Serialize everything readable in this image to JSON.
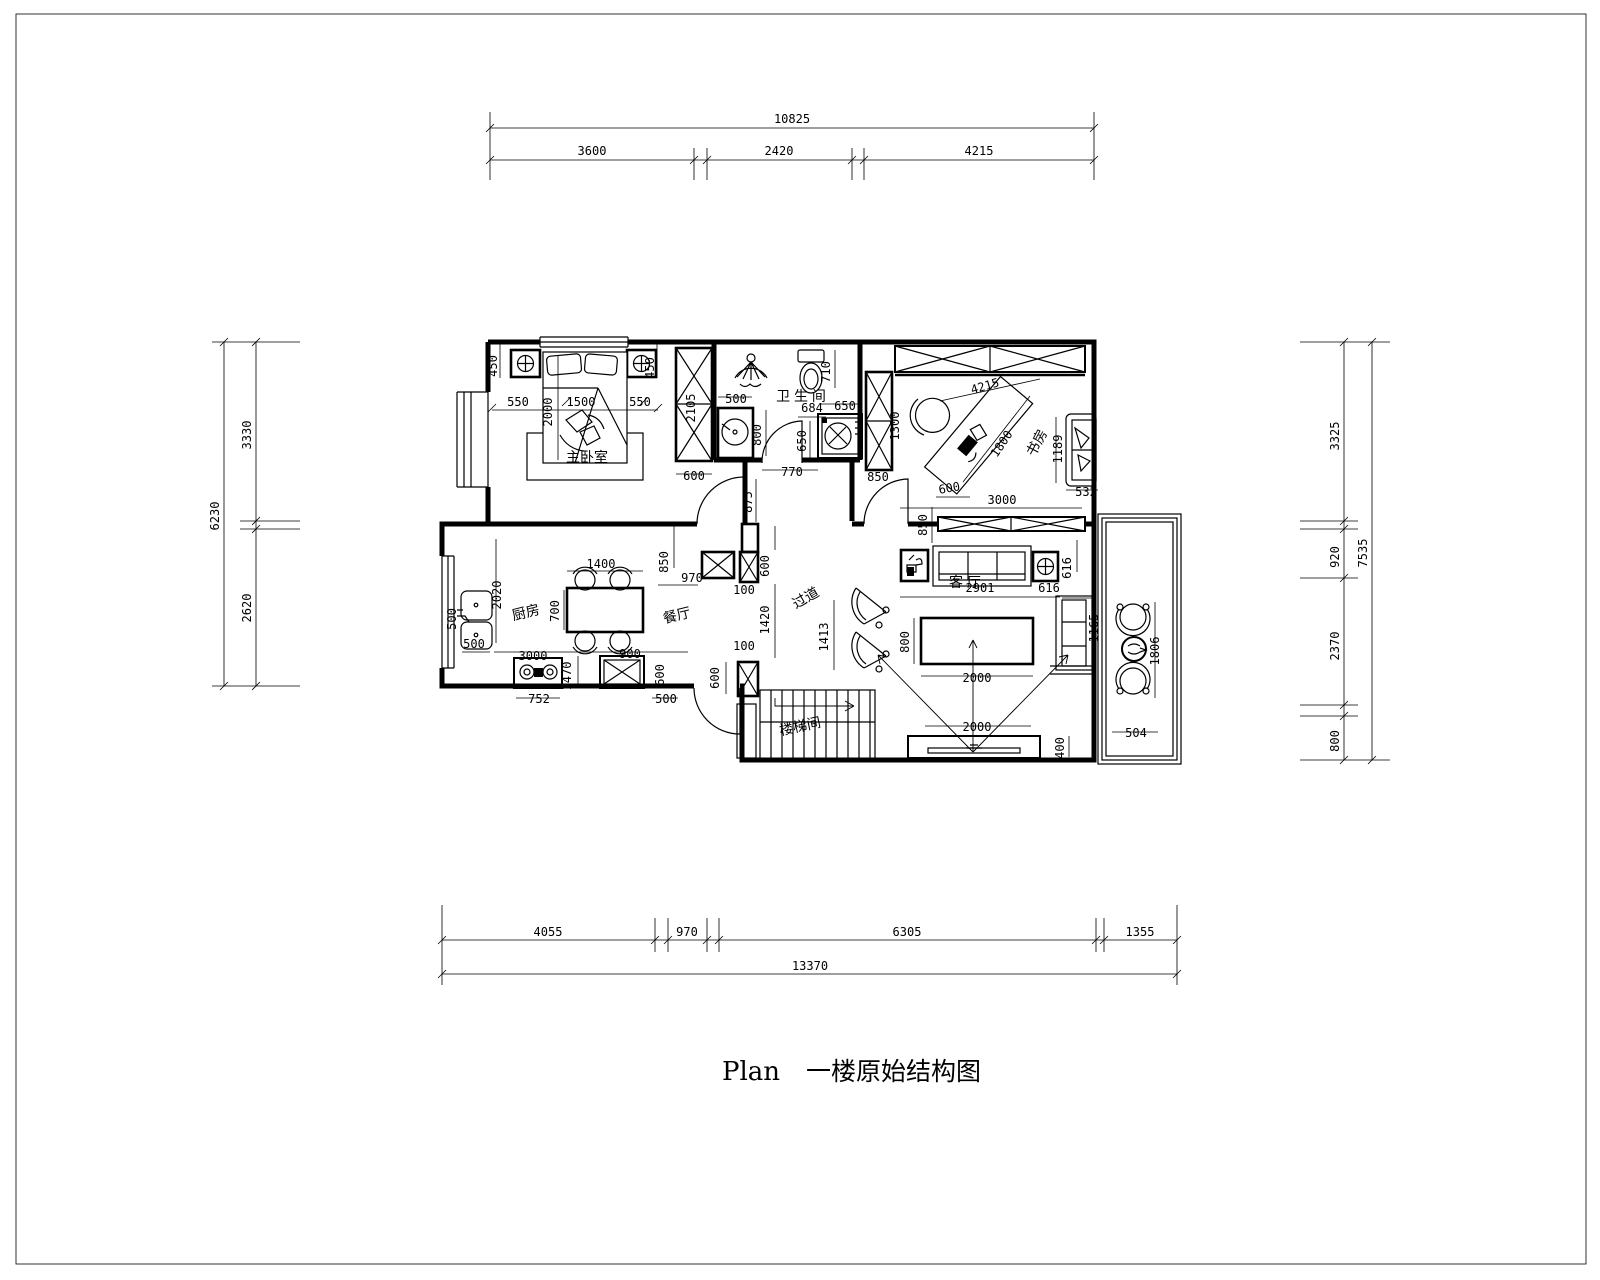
{
  "title": {
    "plan_label": "Plan",
    "plan_title": "一楼原始结构图"
  },
  "colors": {
    "line": "#000000",
    "background": "#ffffff"
  },
  "dim_chains": {
    "top": {
      "total": "10825",
      "segments": [
        "3600",
        "2420",
        "4215"
      ]
    },
    "bottom": {
      "total": "13370",
      "segments": [
        "4055",
        "970",
        "6305",
        "1355"
      ]
    },
    "left": {
      "total": "6230",
      "segments": [
        "3330",
        "2620"
      ]
    },
    "right": {
      "total": "7535",
      "segments": [
        "3325",
        "920",
        "2370",
        "800"
      ]
    }
  },
  "room_labels": [
    {
      "id": "master-bedroom",
      "text": "主卧室",
      "x": 587,
      "y": 462,
      "r": 0
    },
    {
      "id": "bathroom",
      "text": "卫 生 间",
      "x": 801,
      "y": 401,
      "r": 0
    },
    {
      "id": "study",
      "text": "书房",
      "x": 1041,
      "y": 445,
      "r": -62
    },
    {
      "id": "kitchen",
      "text": "厨房",
      "x": 527,
      "y": 617,
      "r": -14
    },
    {
      "id": "dining-room",
      "text": "餐厅",
      "x": 678,
      "y": 620,
      "r": -14
    },
    {
      "id": "corridor",
      "text": "过道",
      "x": 808,
      "y": 602,
      "r": -30
    },
    {
      "id": "living-room",
      "text": "客  厅",
      "x": 965,
      "y": 587,
      "r": 0
    },
    {
      "id": "stairwell",
      "text": "楼梯间",
      "x": 801,
      "y": 731,
      "r": -12
    }
  ],
  "dim_labels": [
    {
      "t": "450",
      "x": 497,
      "y": 366,
      "r": -90
    },
    {
      "t": "550",
      "x": 518,
      "y": 406,
      "r": 0
    },
    {
      "t": "1500",
      "x": 581,
      "y": 406,
      "r": 0
    },
    {
      "t": "550",
      "x": 640,
      "y": 406,
      "r": 0
    },
    {
      "t": "2000",
      "x": 552,
      "y": 412,
      "r": -90
    },
    {
      "t": "450",
      "x": 654,
      "y": 368,
      "r": -90
    },
    {
      "t": "2105",
      "x": 695,
      "y": 408,
      "r": -90
    },
    {
      "t": "600",
      "x": 694,
      "y": 480,
      "r": 0
    },
    {
      "t": "875",
      "x": 752,
      "y": 502,
      "r": -90
    },
    {
      "t": "500",
      "x": 736,
      "y": 403,
      "r": 0
    },
    {
      "t": "800",
      "x": 761,
      "y": 435,
      "r": -90
    },
    {
      "t": "684",
      "x": 812,
      "y": 412,
      "r": 0
    },
    {
      "t": "650",
      "x": 806,
      "y": 441,
      "r": -90
    },
    {
      "t": "650",
      "x": 845,
      "y": 410,
      "r": 0
    },
    {
      "t": "710",
      "x": 830,
      "y": 372,
      "r": -90
    },
    {
      "t": "770",
      "x": 792,
      "y": 476,
      "r": 0
    },
    {
      "t": "1300",
      "x": 899,
      "y": 426,
      "r": -90
    },
    {
      "t": "4215",
      "x": 986,
      "y": 390,
      "r": -16
    },
    {
      "t": "1800",
      "x": 1005,
      "y": 446,
      "r": -56
    },
    {
      "t": "600",
      "x": 950,
      "y": 492,
      "r": -10
    },
    {
      "t": "3000",
      "x": 1002,
      "y": 504,
      "r": 0
    },
    {
      "t": "532",
      "x": 1086,
      "y": 496,
      "r": 0
    },
    {
      "t": "1189",
      "x": 1062,
      "y": 449,
      "r": -90
    },
    {
      "t": "850",
      "x": 878,
      "y": 481,
      "r": 0
    },
    {
      "t": "850",
      "x": 927,
      "y": 525,
      "r": -90
    },
    {
      "t": "970",
      "x": 692,
      "y": 582,
      "r": 0
    },
    {
      "t": "600",
      "x": 769,
      "y": 566,
      "r": -90
    },
    {
      "t": "100",
      "x": 744,
      "y": 594,
      "r": 0
    },
    {
      "t": "1420",
      "x": 769,
      "y": 620,
      "r": -90
    },
    {
      "t": "100",
      "x": 744,
      "y": 650,
      "r": 0
    },
    {
      "t": "600",
      "x": 719,
      "y": 678,
      "r": -90
    },
    {
      "t": "1413",
      "x": 828,
      "y": 637,
      "r": -90
    },
    {
      "t": "2020",
      "x": 501,
      "y": 595,
      "r": -90
    },
    {
      "t": "1400",
      "x": 601,
      "y": 568,
      "r": 0
    },
    {
      "t": "700",
      "x": 559,
      "y": 611,
      "r": -90
    },
    {
      "t": "3000",
      "x": 533,
      "y": 660,
      "r": 0
    },
    {
      "t": "900",
      "x": 630,
      "y": 658,
      "r": 0
    },
    {
      "t": "850",
      "x": 668,
      "y": 562,
      "r": -90
    },
    {
      "t": "500",
      "x": 474,
      "y": 648,
      "r": 0
    },
    {
      "t": "500",
      "x": 456,
      "y": 619,
      "r": -90
    },
    {
      "t": "752",
      "x": 539,
      "y": 703,
      "r": 0
    },
    {
      "t": "1470",
      "x": 571,
      "y": 676,
      "r": -90
    },
    {
      "t": "600",
      "x": 664,
      "y": 675,
      "r": -90
    },
    {
      "t": "500",
      "x": 666,
      "y": 703,
      "r": 0
    },
    {
      "t": "2901",
      "x": 980,
      "y": 592,
      "r": 0
    },
    {
      "t": "616",
      "x": 1071,
      "y": 568,
      "r": -90
    },
    {
      "t": "616",
      "x": 1049,
      "y": 592,
      "r": 0
    },
    {
      "t": "1165",
      "x": 1098,
      "y": 628,
      "r": -90
    },
    {
      "t": "800",
      "x": 909,
      "y": 642,
      "r": -90
    },
    {
      "t": "2000",
      "x": 977,
      "y": 682,
      "r": 0
    },
    {
      "t": "2000",
      "x": 977,
      "y": 731,
      "r": 0
    },
    {
      "t": "400",
      "x": 1064,
      "y": 748,
      "r": -90
    },
    {
      "t": "1806",
      "x": 1159,
      "y": 651,
      "r": -90
    },
    {
      "t": "504",
      "x": 1136,
      "y": 737,
      "r": 0
    }
  ]
}
